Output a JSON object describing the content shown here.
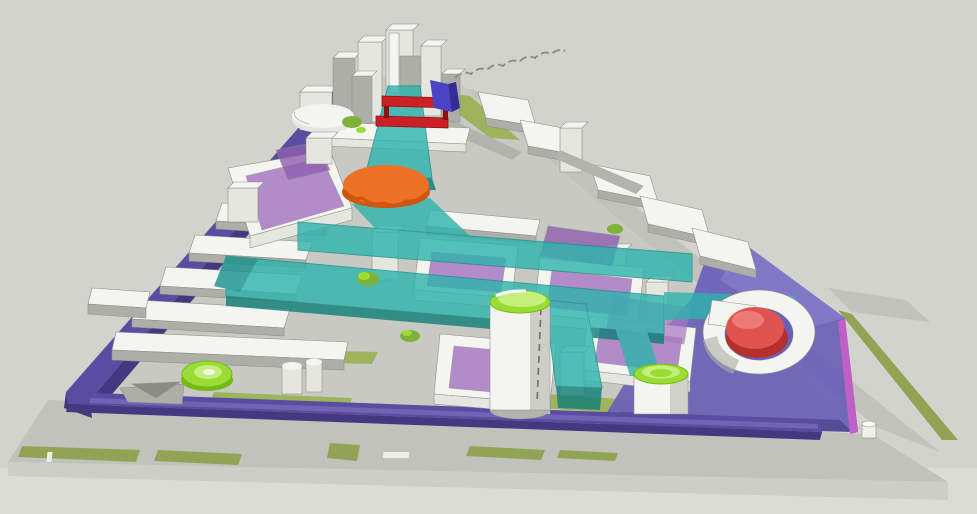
{
  "title": "3D urban masterplan massing model",
  "colors": {
    "bg": "#d2d3cd",
    "bg_bottom": "#dcdcd6",
    "road": "#c1c2bc",
    "road_light": "#cdcec8",
    "site_ground": "#c8c9c3",
    "verge_green": "#93a355",
    "lawn_green": "#9db45c",
    "tree_green": "#7fb23a",
    "bldg_top": "#f4f4f0",
    "bldg_face": "#e6e6e1",
    "bldg_side": "#adaea8",
    "bldg_outline": "#90918b",
    "shadow": "#b2b3ad",
    "loop_purple": "#5a4da1",
    "loop_purple_light": "#7a6ebc",
    "loop_purple_dark": "#443880",
    "plaza_purple": "#6a5fb7",
    "plaza_purple_light": "#837ac9",
    "plaza_edge_magenta": "#c05fc5",
    "courtyard_orchid": "#a878c4",
    "courtyard_orchid_dark": "#8f5fb0",
    "teal": "#2eb4ad",
    "teal_dark": "#17918b",
    "teal_deep": "#0f7f79",
    "lime": "#9bdb35",
    "lime_dark": "#74bb17",
    "lime_light": "#c3ef7a",
    "orange": "#ee7226",
    "orange_dark": "#cf5510",
    "red_blob": "#e05450",
    "red_blob_dark": "#b5302c",
    "red_gate": "#cd1f26",
    "indigo_slab": "#4a43c4",
    "sketch_gray": "#8f908a"
  },
  "scene": {
    "kind": "aerial-3d-massing-model",
    "site_shape": "triangular district viewed in perspective from south-east above",
    "elements": [
      "north-tower-cluster",
      "red-gate-bars-over-teal-ramp",
      "indigo-vertical-slab",
      "teal-elevated-corridor-network",
      "orange-scalloped-dome",
      "orchid-courtyard-overlays",
      "purple-boundary-loop-band",
      "southeast-purple-plaza",
      "white-cylinder-tower-lime-cap",
      "lime-cylinder-pavilion",
      "lime-round-pavilion",
      "horseshoe-building-red-dome",
      "northeast-slab-row",
      "west-slab-rows",
      "lawn-patches-and-tree-blobs",
      "perimeter-roads-with-verges",
      "sketch-dashed-line"
    ]
  }
}
